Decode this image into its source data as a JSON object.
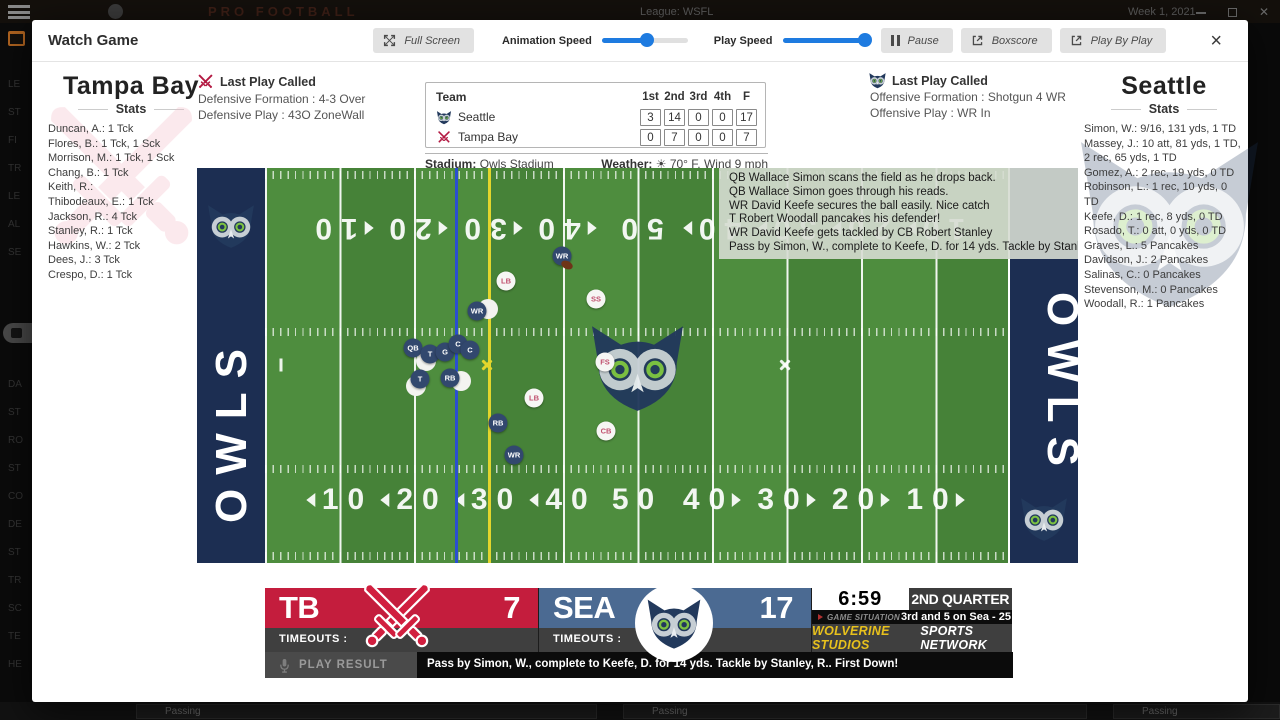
{
  "backdrop": {
    "top_bar": {
      "brand": "PRO FOOTBALL",
      "league": "League: WSFL",
      "week": "Week 1, 2021"
    },
    "sidebar": {
      "items_top": [
        "LE",
        "ST",
        "FI",
        "TR",
        "LE",
        "AL",
        "SE"
      ],
      "items_bottom": [
        "DA",
        "ST",
        "RO",
        "ST",
        "CO",
        "DE",
        "ST",
        "TR",
        "SC",
        "TE",
        "HE"
      ]
    },
    "bottom_tables": [
      "Passing",
      "Passing",
      "Passing"
    ]
  },
  "modal": {
    "title": "Watch Game",
    "toolbar": {
      "full_screen": "Full Screen",
      "animation_speed_label": "Animation Speed",
      "animation_speed_pct": 52,
      "play_speed_label": "Play Speed",
      "play_speed_pct": 96,
      "pause": "Pause",
      "boxscore": "Boxscore",
      "play_by_play": "Play By Play",
      "close": "×"
    }
  },
  "away": {
    "name": "Tampa Bay",
    "stats_label": "Stats",
    "stats": [
      "Duncan, A.: 1 Tck",
      "Flores, B.: 1 Tck, 1 Sck",
      "Morrison, M.: 1 Tck, 1 Sck",
      "Chang, B.: 1 Tck",
      "Keith, R.:",
      "Thibodeaux, E.: 1 Tck",
      "Jackson, R.: 4 Tck",
      "Stanley, R.: 1 Tck",
      "Hawkins, W.: 2 Tck",
      "Dees, J.: 3 Tck",
      "Crespo, D.: 1 Tck"
    ],
    "last_play": {
      "title": "Last Play Called",
      "formation": "Defensive Formation : 4-3 Over",
      "play": "Defensive Play : 43O ZoneWall"
    }
  },
  "home": {
    "name": "Seattle",
    "stats_label": "Stats",
    "stats": [
      "Simon, W.: 9/16, 131 yds, 1 TD",
      "Massey, J.: 10 att, 81 yds, 1 TD, 2 rec, 65 yds, 1 TD",
      "Gomez, A.: 2 rec, 19 yds, 0 TD",
      "Robinson, L.: 1 rec, 10 yds, 0 TD",
      "Keefe, D.: 1 rec, 8 yds, 0 TD",
      "Rosado, T.: 0 att, 0 yds, 0 TD",
      "Graves, L.: 5 Pancakes",
      "Davidson, J.: 2 Pancakes",
      "Salinas, C.: 0 Pancakes",
      "Stevenson, M.: 0 Pancakes",
      "Woodall, R.: 1 Pancakes"
    ],
    "last_play": {
      "title": "Last Play Called",
      "formation": "Offensive Formation : Shotgun 4 WR",
      "play": "Offensive Play : WR In"
    }
  },
  "scoreboard": {
    "team_header": "Team",
    "period_headers": [
      "1st",
      "2nd",
      "3rd",
      "4th",
      "F"
    ],
    "rows": [
      {
        "team": "Seattle",
        "scores": [
          "3",
          "14",
          "0",
          "0",
          "17"
        ]
      },
      {
        "team": "Tampa Bay",
        "scores": [
          "0",
          "7",
          "0",
          "0",
          "7"
        ]
      }
    ]
  },
  "venue": {
    "stadium_label": "Stadium:",
    "stadium": "Owls Stadium",
    "weather_label": "Weather:",
    "weather": "70° F, Wind 9 mph"
  },
  "field": {
    "endzone_text": "OWLS",
    "yard_numbers": [
      "10",
      "20",
      "30",
      "40",
      "50",
      "40",
      "30",
      "20",
      "10"
    ],
    "scrimmage_x": 258,
    "first_down_x": 291,
    "commentary": [
      "QB Wallace Simon scans the field as he drops back.",
      "QB Wallace Simon goes through his reads.",
      "WR David Keefe secures the ball easily. Nice catch",
      "T Robert Woodall pancakes his defender!",
      "WR David Keefe gets tackled by CB Robert Stanley",
      "Pass by Simon, W., complete to Keefe, D. for 14 yds. Tackle by Stanley, R.. First Down!"
    ],
    "players": [
      {
        "side": "w",
        "x": 291,
        "y": 141
      },
      {
        "side": "w",
        "x": 229,
        "y": 193
      },
      {
        "side": "w",
        "x": 219,
        "y": 218
      },
      {
        "side": "w",
        "x": 264,
        "y": 213
      },
      {
        "side": "d",
        "label": "LB",
        "x": 309,
        "y": 113
      },
      {
        "side": "d",
        "label": "SS",
        "x": 399,
        "y": 131
      },
      {
        "side": "d",
        "label": "FS",
        "x": 408,
        "y": 194
      },
      {
        "side": "d",
        "label": "LB",
        "x": 337,
        "y": 230
      },
      {
        "side": "d",
        "label": "CB",
        "x": 409,
        "y": 263
      },
      {
        "side": "o",
        "label": "WR",
        "x": 365,
        "y": 88
      },
      {
        "side": "o",
        "label": "WR",
        "x": 280,
        "y": 143
      },
      {
        "side": "o",
        "label": "QB",
        "x": 216,
        "y": 180
      },
      {
        "side": "o",
        "label": "T",
        "x": 233,
        "y": 186
      },
      {
        "side": "o",
        "label": "G",
        "x": 248,
        "y": 184
      },
      {
        "side": "o",
        "label": "C",
        "x": 261,
        "y": 176
      },
      {
        "side": "o",
        "label": "C",
        "x": 273,
        "y": 182
      },
      {
        "side": "o",
        "label": "T",
        "x": 223,
        "y": 211
      },
      {
        "side": "o",
        "label": "RB",
        "x": 253,
        "y": 210
      },
      {
        "side": "o",
        "label": "RB",
        "x": 301,
        "y": 255
      },
      {
        "side": "o",
        "label": "WR",
        "x": 317,
        "y": 287
      }
    ],
    "ball": {
      "x": 370,
      "y": 97
    },
    "markers": [
      {
        "type": "tick",
        "x": 84,
        "y": 197
      },
      {
        "type": "x-yellow",
        "x": 290,
        "y": 197
      },
      {
        "type": "x-white",
        "x": 588,
        "y": 197
      }
    ]
  },
  "bottom_bar": {
    "away_abbr": "TB",
    "away_score": "7",
    "home_abbr": "SEA",
    "home_score": "17",
    "timeouts_label": "TIMEOUTS :",
    "clock": "6:59",
    "quarter": "2ND QUARTER",
    "situation_label": "GAME SITUATION",
    "situation": "3rd and 5 on Sea - 25",
    "network_brand": "WOLVERINE STUDIOS",
    "network_rest": "SPORTS NETWORK",
    "play_result_label": "PLAY RESULT",
    "play_result": "Pass by Simon, W., complete to Keefe, D. for 14 yds. Tackle by Stanley, R.. First Down!"
  }
}
